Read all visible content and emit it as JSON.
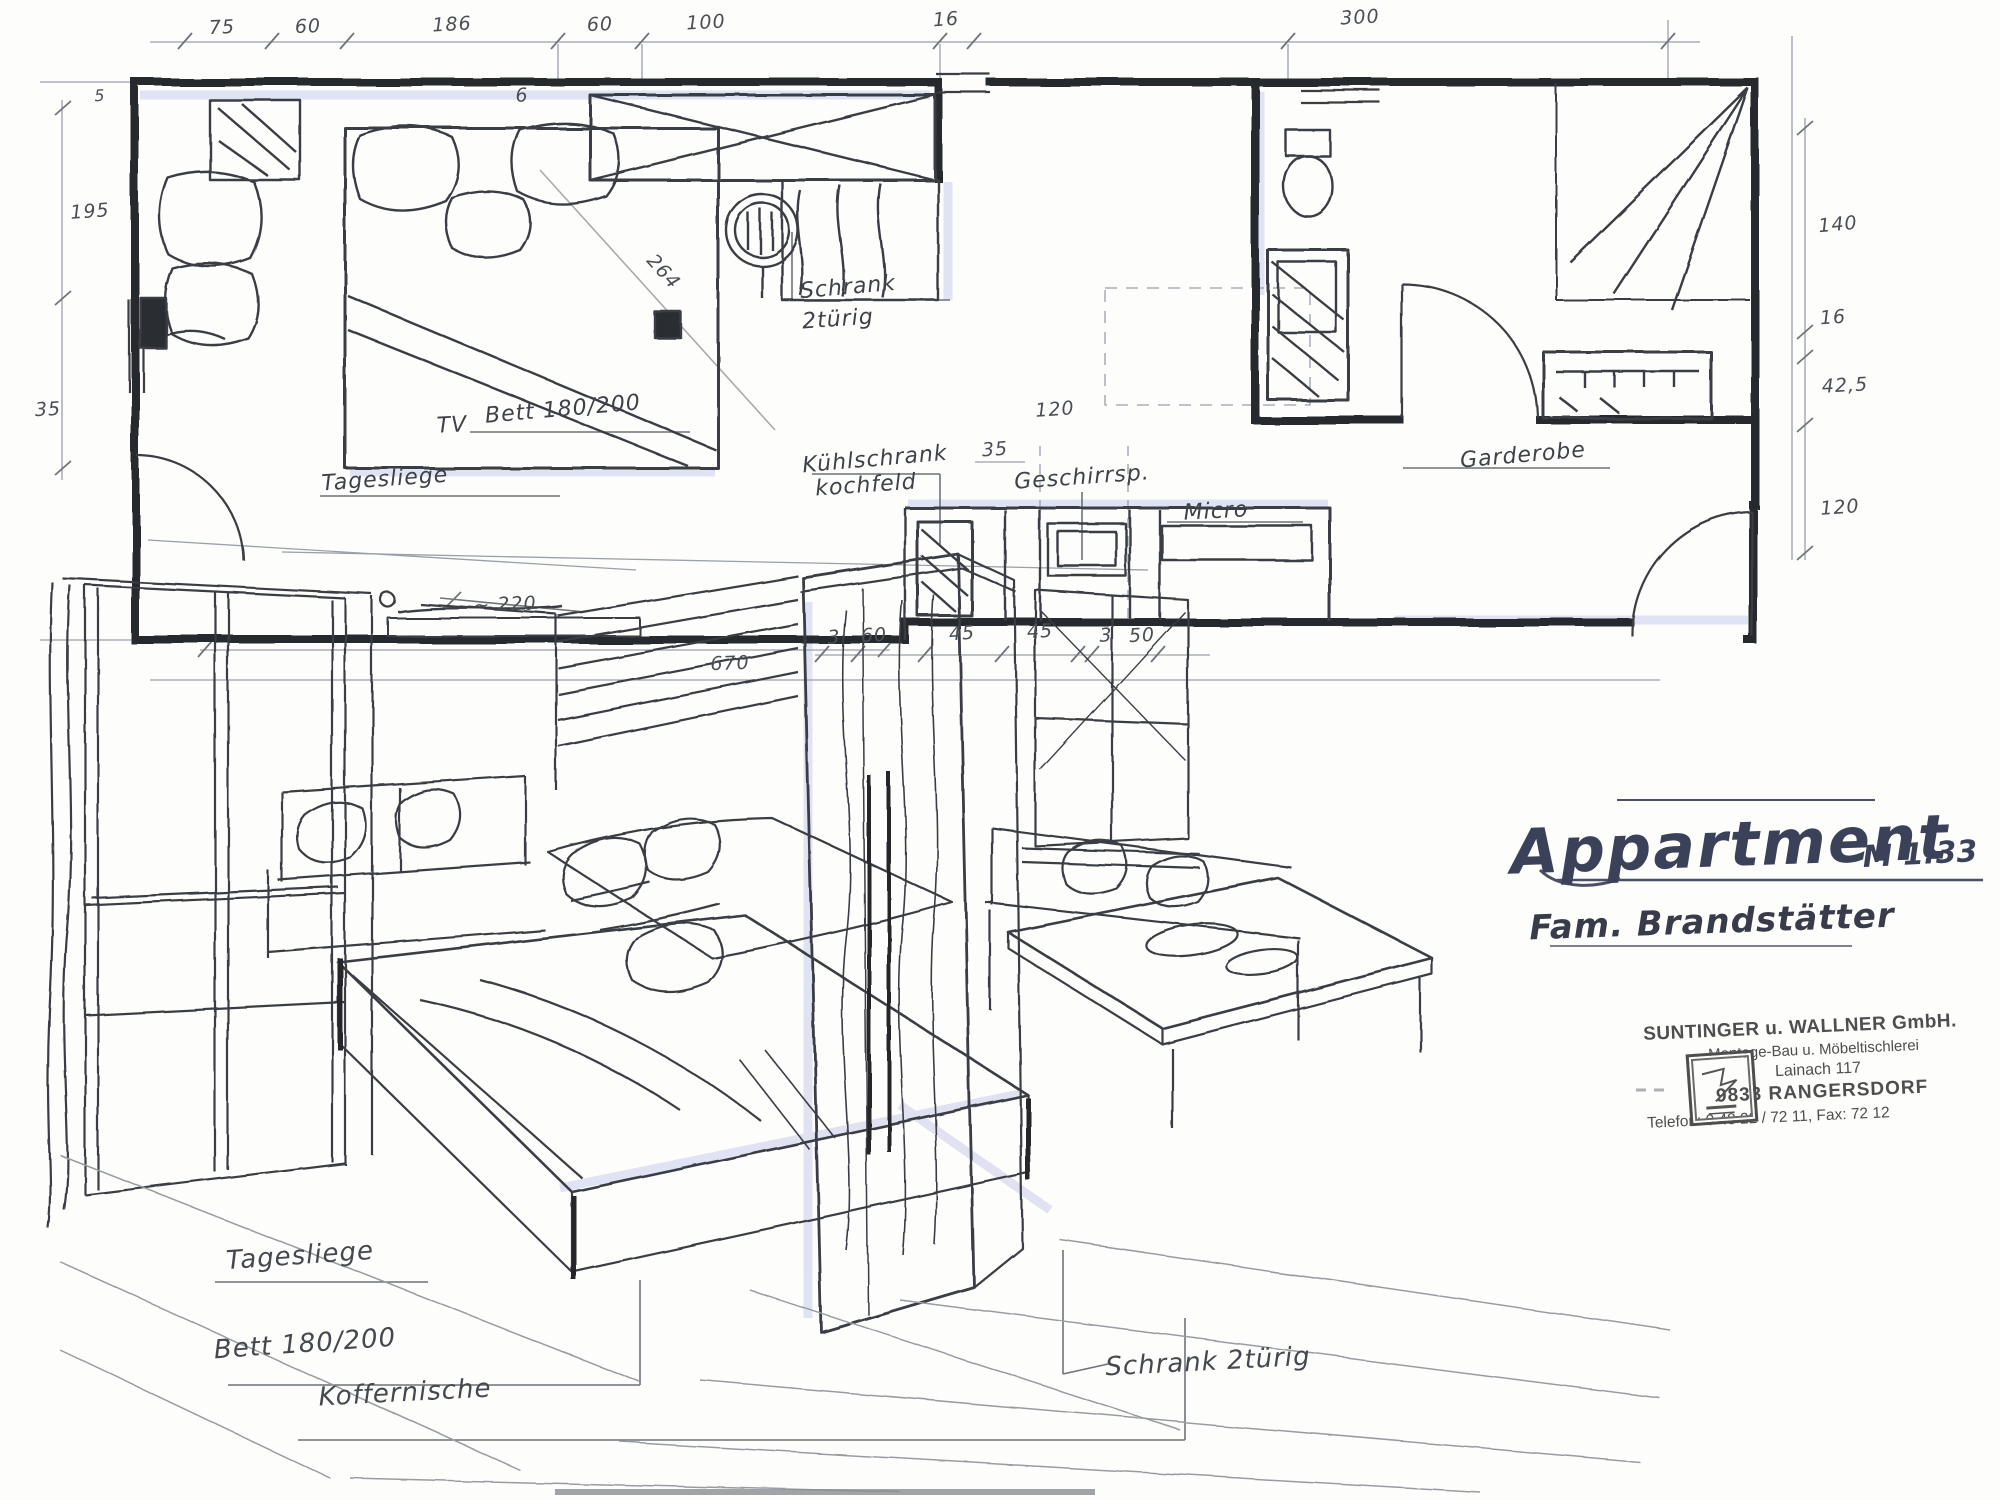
{
  "title_block": {
    "project": "Appartment",
    "scale": "M 1:33",
    "client": "Fam. Brandstätter"
  },
  "stamp": {
    "company": "SUNTINGER u. WALLNER GmbH.",
    "trade": "Montage-Bau u. Möbeltischlerei",
    "street": "Lainach 117",
    "city": "9833 RANGERSDORF",
    "phone": "Telefon: 0 48 22 / 72 11,  Fax: 72 12"
  },
  "floor_plan": {
    "labels": {
      "schrank_line1": "Schrank",
      "schrank_line2": "2türig",
      "bett": "Bett 180/200",
      "tagesliege": "Tagesliege",
      "tv": "TV",
      "kuehlschrank_line1": "Kühlschrank",
      "kuehlschrank_line2": "kochfeld",
      "geschirrspueler": "Geschirrsp.",
      "micro": "Micro",
      "garderobe": "Garderobe"
    },
    "dimensions": {
      "top": [
        "75",
        "60",
        "186",
        "60",
        "100",
        "16",
        "300"
      ],
      "left": [
        "195",
        "35"
      ],
      "right": [
        "140",
        "16",
        "42,5",
        "120"
      ],
      "bottom": [
        "670",
        "3",
        "60",
        "45",
        "45",
        "3",
        "50"
      ],
      "inner": {
        "bed_diagonal": "264",
        "wall_six": "6",
        "corner_five": "5",
        "micro_width": "35",
        "micro_depth": "120"
      }
    }
  },
  "sketch": {
    "labels": {
      "tagesliege": "Tagesliege",
      "bett": "Bett 180/200",
      "koffernische": "Koffernische",
      "schrank": "Schrank 2türig"
    },
    "annotation_width": "~ 220"
  },
  "colors": {
    "ink": "#3e4147",
    "wall": "#26292e",
    "shading": "#c4c9ea",
    "dimension": "#9aa0a8"
  }
}
